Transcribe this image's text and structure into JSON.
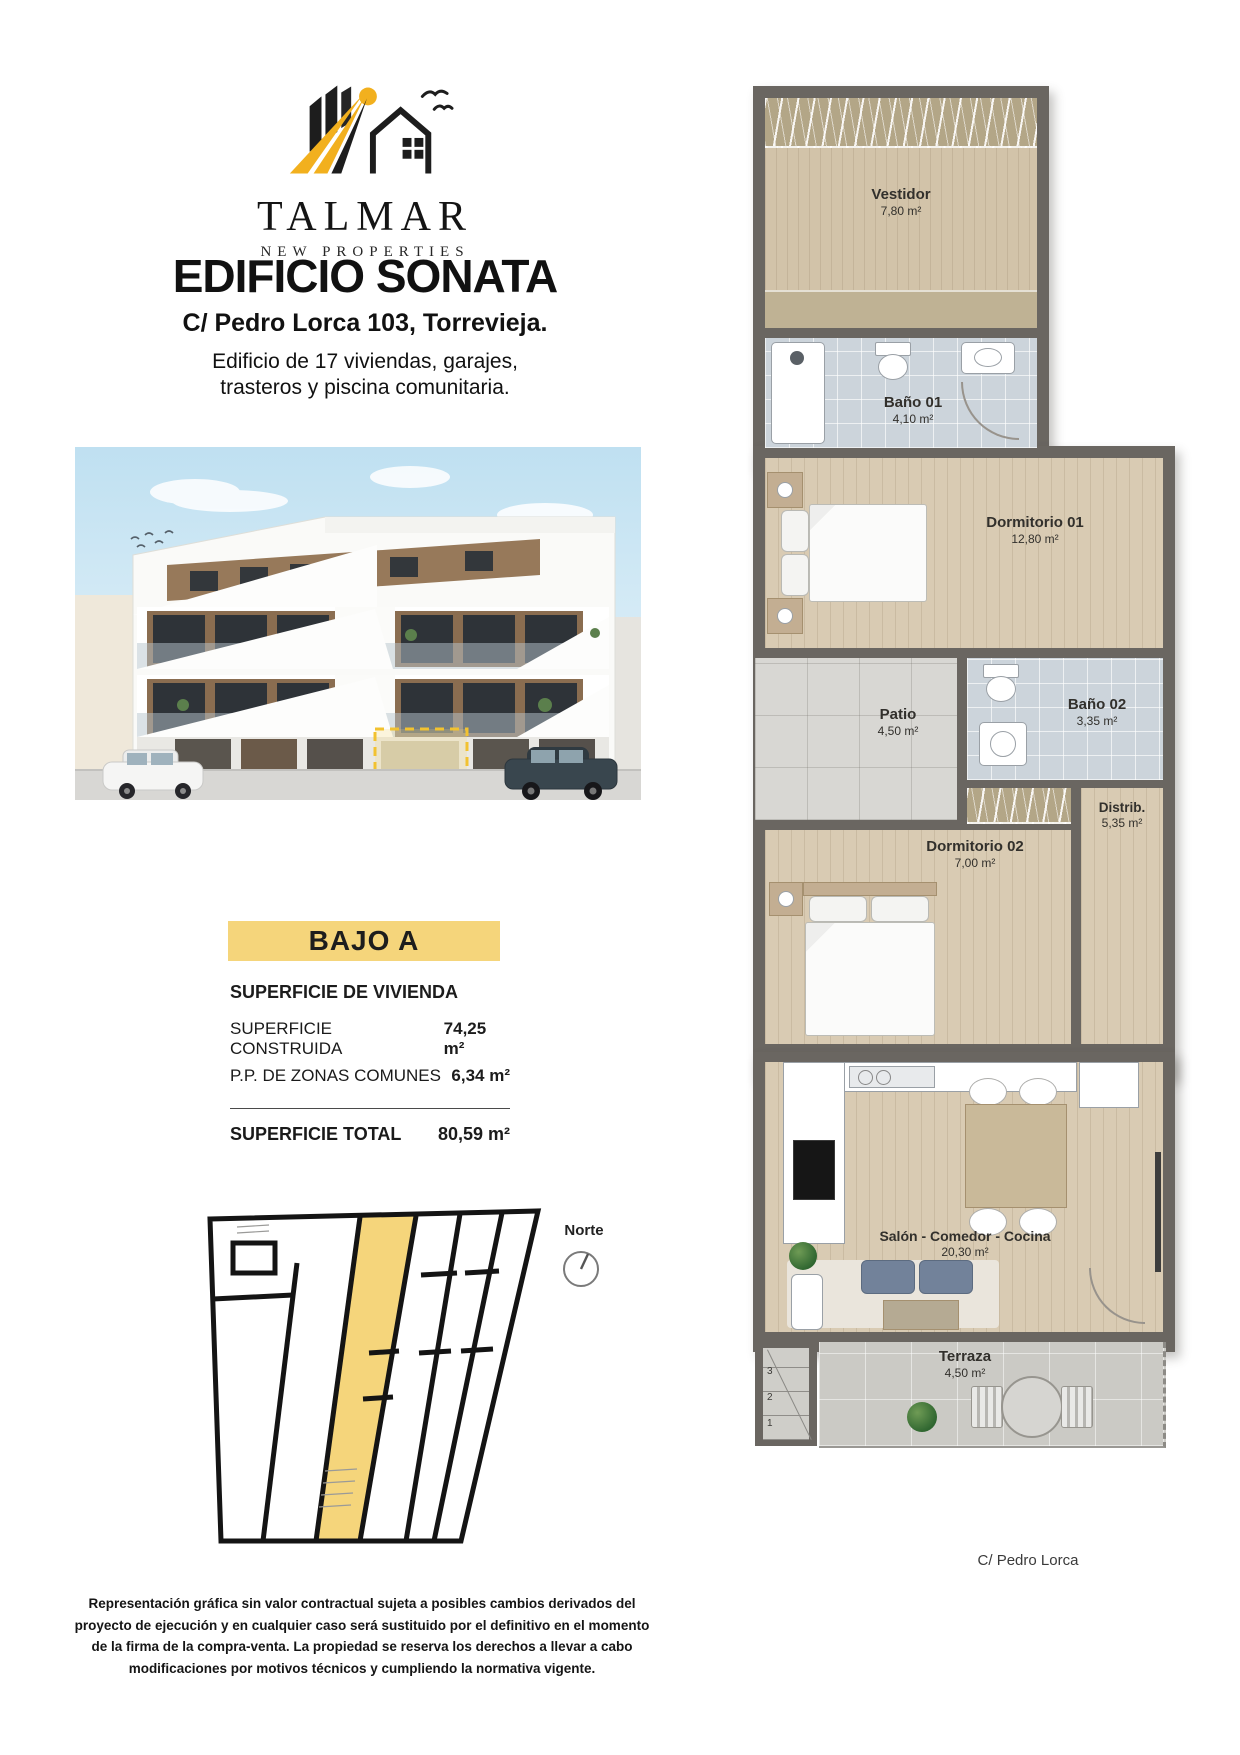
{
  "brand": {
    "name": "TALMAR",
    "tagline": "NEW PROPERTIES"
  },
  "header": {
    "title": "EDIFICIO SONATA",
    "address": "C/ Pedro Lorca 103, Torrevieja.",
    "description_line1": "Edificio de 17 viviendas, garajes,",
    "description_line2": "trasteros y piscina comunitaria."
  },
  "unit": {
    "label": "BAJO A"
  },
  "surface_table": {
    "heading": "SUPERFICIE DE VIVIENDA",
    "rows": [
      {
        "label": "SUPERFICIE CONSTRUIDA",
        "value": "74,25 m²"
      },
      {
        "label": "P.P. DE ZONAS COMUNES",
        "value": "6,34 m²"
      }
    ],
    "total": {
      "label": "SUPERFICIE TOTAL",
      "value": "80,59 m²"
    }
  },
  "keyplan": {
    "north_label": "Norte"
  },
  "floorplan": {
    "rooms": [
      {
        "name": "Vestidor",
        "area": "7,80 m²"
      },
      {
        "name": "Baño 01",
        "area": "4,10 m²"
      },
      {
        "name": "Dormitorio 01",
        "area": "12,80 m²"
      },
      {
        "name": "Patio",
        "area": "4,50 m²"
      },
      {
        "name": "Baño 02",
        "area": "3,35 m²"
      },
      {
        "name": "Dormitorio 02",
        "area": "7,00 m²"
      },
      {
        "name": "Distrib.",
        "area": "5,35 m²"
      },
      {
        "name": "Salón - Comedor - Cocina",
        "area": "20,30 m²"
      },
      {
        "name": "Terraza",
        "area": "4,50 m²"
      }
    ],
    "stair_steps": [
      "3",
      "2",
      "1"
    ],
    "street_label": "C/ Pedro Lorca"
  },
  "disclaimer": "Representación gráfica sin valor contractual sujeta a posibles cambios derivados del proyecto de ejecución y en cualquier caso será sustituido por el definitivo en el momento de la firma de la compra-venta. La propiedad se reserva los derechos a llevar a cabo modificaciones por motivos técnicos y cumpliendo la normativa vigente.",
  "colors": {
    "accent_yellow": "#F5D57B",
    "highlight_dash": "#F2C230",
    "wall_gray": "#6A6661",
    "wood_floor": "#D9CBB3",
    "bath_floor": "#CCD4DB"
  }
}
